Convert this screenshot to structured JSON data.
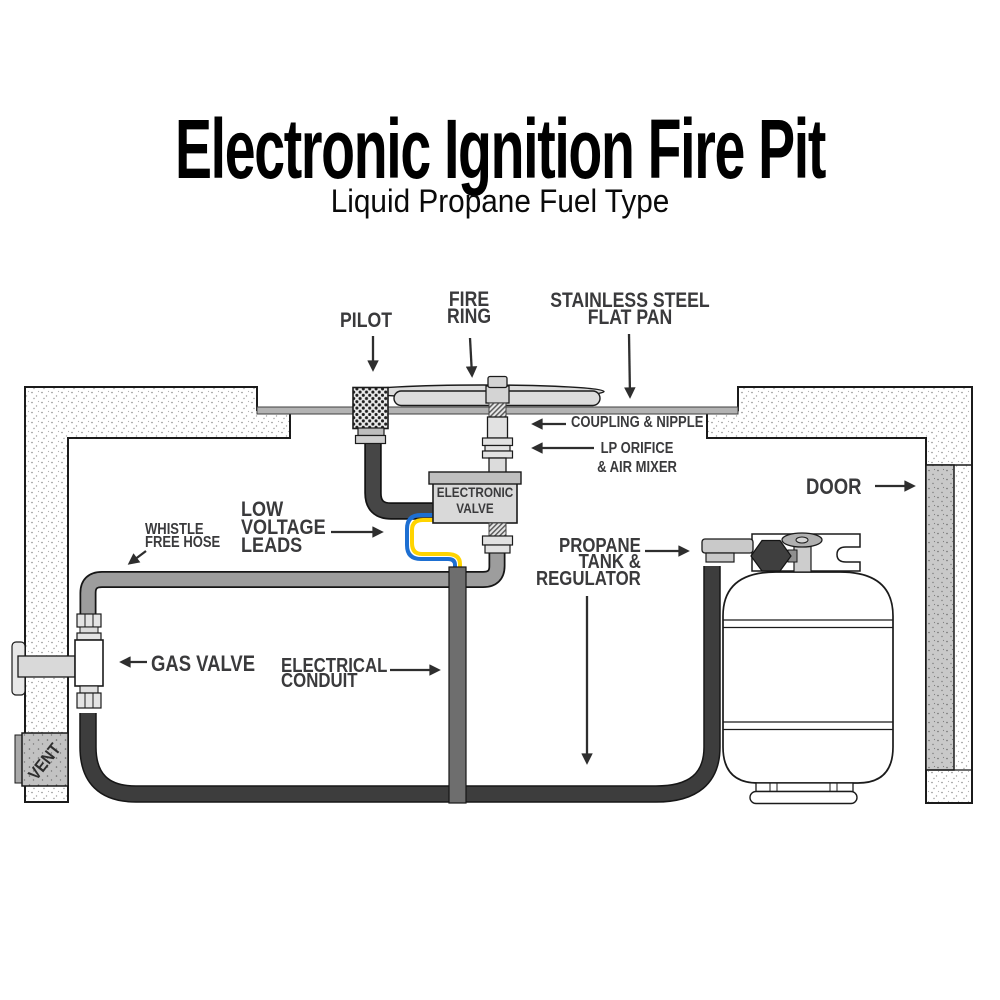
{
  "title": {
    "text": "Electronic Ignition Fire Pit",
    "subtitle": "Liquid Propane Fuel Type"
  },
  "labels": {
    "pilot": {
      "text": "PILOT"
    },
    "fire_ring": {
      "line1": "FIRE",
      "line2": "RING"
    },
    "flat_pan": {
      "line1": "STAINLESS STEEL",
      "line2": "FLAT PAN"
    },
    "coupling_nipple": {
      "text": "COUPLING & NIPPLE"
    },
    "lp_orifice": {
      "line1": "LP ORIFICE",
      "line2": "& AIR MIXER"
    },
    "door": {
      "text": "DOOR"
    },
    "whistle_hose": {
      "line1": "WHISTLE",
      "line2": "FREE HOSE"
    },
    "low_voltage": {
      "line1": "LOW",
      "line2": "VOLTAGE",
      "line3": "LEADS"
    },
    "electrical_conduit": {
      "line1": "ELECTRICAL",
      "line2": "CONDUIT"
    },
    "gas_valve": {
      "text": "GAS VALVE"
    },
    "propane": {
      "line1": "PROPANE",
      "line2": "TANK &",
      "line3": "REGULATOR"
    },
    "electronic_valve": {
      "line1": "ELECTRONIC",
      "line2": "VALVE"
    },
    "vent": {
      "text": "VENT"
    }
  },
  "colors": {
    "label_text": "#3a3a3c",
    "title_text": "#000000",
    "hose_dark": "#3d3d3d",
    "hose_gray": "#9d9d9d",
    "conduit_gray": "#6e6e6e",
    "wire_blue": "#1d6fd2",
    "wire_yellow": "#ffd400",
    "metal_light": "#dcdcdc",
    "door_gray": "#c9c9c9",
    "regulator_dark": "#3f3f3f"
  }
}
